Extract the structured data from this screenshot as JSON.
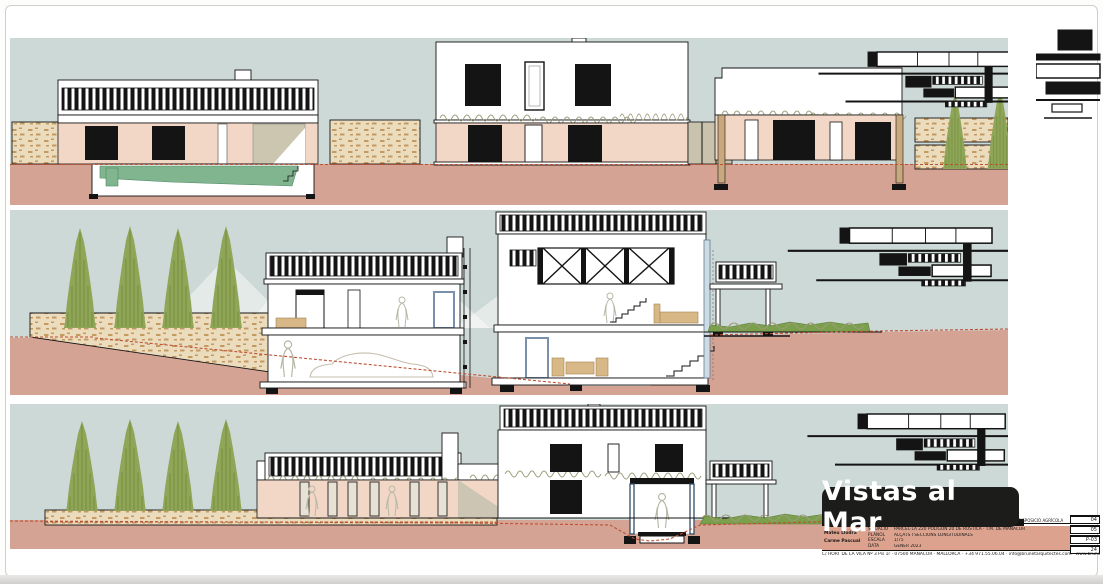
{
  "badge": {
    "label": "Vistas al Mar"
  },
  "title_block": {
    "header_note": "DISPOSICIÓ AGRÍCOLA",
    "architect_1": "Mateu Llodrà",
    "architect_2": "Carme Pascual",
    "rows": [
      {
        "label": "SITUACIÓ",
        "value": "PARCEL·LA 220 POLÍGON 20 DE RÚSTICA · T.M. DE MANACOR"
      },
      {
        "label": "PLÀNOL",
        "value": "ALÇATS I SECCIONS LONGITUDINALS"
      },
      {
        "label": "ESCALA",
        "value": "1/75"
      },
      {
        "label": "DATA",
        "value": "GENER 2023"
      }
    ],
    "numbers": {
      "n1": "04",
      "n2": "05",
      "code": "P-03",
      "n3": "24"
    },
    "address": "C/ HORT DE LA VILA Nº 3 Pis 1r · 07500 MANACOR · MALLORCA · +34 971.55.06.04 · info@brunetarquitectes.com · www.brunetarquitectes.com"
  },
  "colors": {
    "sky": "#cdd9d6",
    "ground": "#d4a394",
    "wall_pink": "#f2d7c6",
    "stone": "#ebdcbe",
    "stone_mark": "#c59a62",
    "pool_green": "#81b590",
    "cypress_green": "#8fa557",
    "cypress_dark": "#6d8a39",
    "hedge_green": "#7aa04c",
    "grade_red": "#bf4f33",
    "badge_bg": "#1c1c1a",
    "badge_text": "#ffffff",
    "titleblock_pink": "#dca28d",
    "frame_blue": "#7b90ad",
    "furniture_tan": "#d8b887",
    "glass_tan": "#c9c3ae",
    "ink": "#141414"
  }
}
